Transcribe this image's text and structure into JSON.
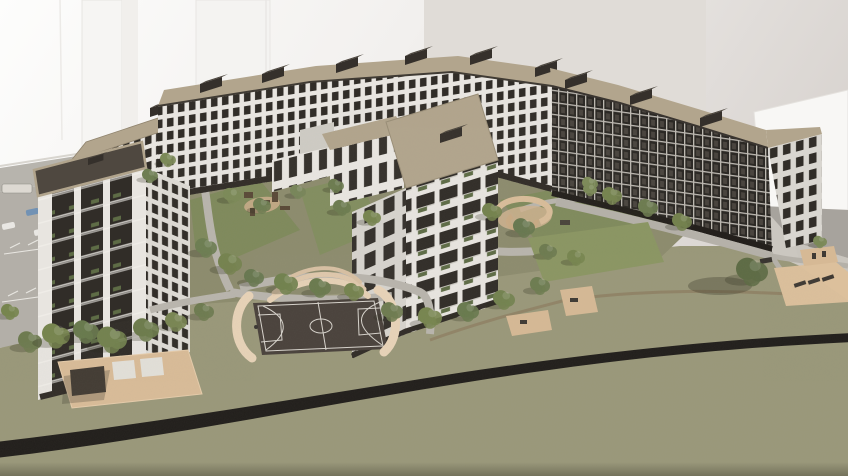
{
  "scene": {
    "type": "3d-architectural-rendering",
    "description": "Aerial 3D visualization of a residential apartment complex: U-shaped multi-storey blocks with tan flat roofs and dark rooftop cores around a landscaped courtyard, a foreground tower, a basketball court enclosed by cream curved walls with amphitheater tiers, playgrounds, sandy picnic areas with pergola and loungers, tree clusters, a parking lot with cars at left, olive-green lawns crossed by a dark curving road, and pale background buildings."
  },
  "palette": {
    "sky_top": "#fdfdfc",
    "sky_right": "#d7d2ce",
    "slab": "#e0dcd7",
    "bg_box": "#f8f7f5",
    "bg_ground": "#cbc7c0",
    "bank_dark": "#a7a39d",
    "bank_light": "#c9c5be",
    "roof_tan": "#b2a58d",
    "roof_dark": "#4f4840",
    "core_dark": "#35302b",
    "facade_white": "#e8e5e0",
    "facade_light": "#d9d6d0",
    "facade_dark": "#2c2925",
    "window_dark": "#312d28",
    "grid_white": "#bdb9b2",
    "balcony_green": "#5e6c46",
    "grass": "#9a987a",
    "courtyard": "#8d8c6e",
    "lawn": "#7f8a5c",
    "lawn_bright": "#8b9663",
    "path_gray": "#b9b5ad",
    "path_brown": "#8e7f63",
    "sand": "#d9bc98",
    "wall_cream": "#e8d3b8",
    "court_dark": "#4a423c",
    "court_line": "#d8d4cd",
    "road_dark": "#211e1b",
    "parking": "#b3afa8",
    "marking": "#e8e6e1",
    "tree_green": "#73824f",
    "tree_dark": "#5d6b44",
    "car_blue": "#7292b4",
    "plinth": "#322d28"
  },
  "elements": [
    {
      "name": "background-buildings",
      "label": "faint white high-rise silhouettes"
    },
    {
      "name": "left-tower",
      "label": "9-storey tower, white piers with dark balcony strips"
    },
    {
      "name": "back-left-block",
      "label": "mid-rise block with tan roof"
    },
    {
      "name": "north-wing",
      "label": "long rear wing, white grid facade"
    },
    {
      "name": "east-wing",
      "label": "east wing, dark grid facade with gable end"
    },
    {
      "name": "center-tower",
      "label": "central tower with planted balconies"
    },
    {
      "name": "courtyard",
      "label": "landscaped courtyard with playgrounds and paths"
    },
    {
      "name": "basketball-court",
      "label": "dark court with white markings and cream curved walls"
    },
    {
      "name": "picnic-area",
      "label": "sandy strip with pergola"
    },
    {
      "name": "lounger-area",
      "label": "sandy patch with sun loungers"
    },
    {
      "name": "parking-lot",
      "label": "car park with marked stalls and vehicles"
    },
    {
      "name": "road",
      "label": "dark asphalt path curving across the lawn"
    },
    {
      "name": "trees",
      "label": "green tree clusters"
    }
  ]
}
